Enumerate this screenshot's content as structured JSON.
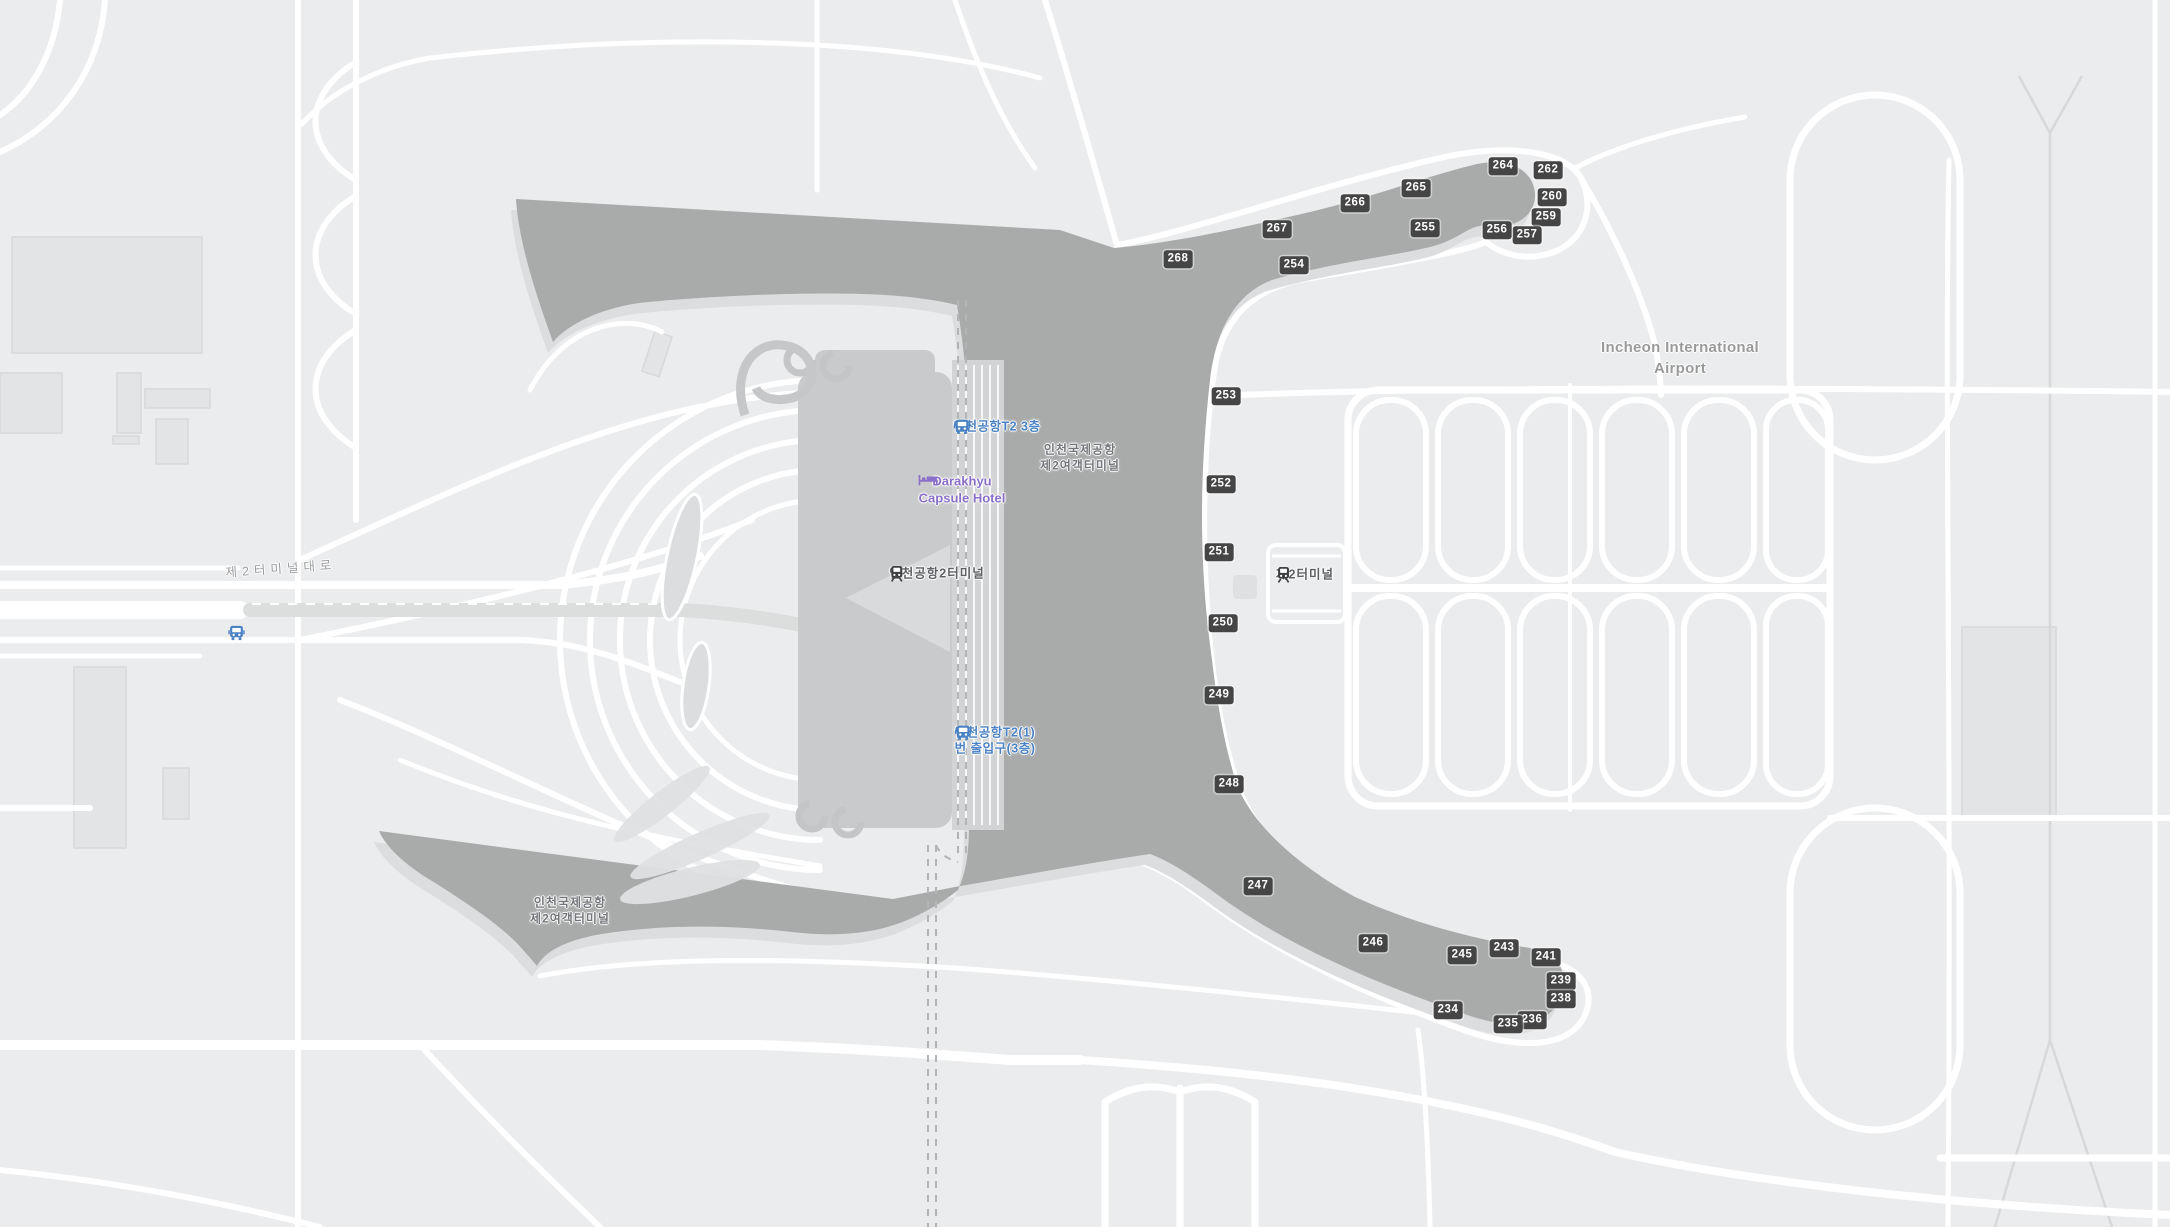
{
  "map": {
    "title": "Incheon International Airport Terminal 2 map",
    "colors": {
      "background": "#ebeced",
      "road": "#ffffff",
      "apron": "#a9abab",
      "apron_shadow": "#dcddde",
      "terminal_building": "#c9cacb",
      "terminal_wing": "#d9dadb",
      "building_light": "#e3e4e5",
      "building_stroke": "#d8d9da",
      "median_gray": "#dcdddd",
      "rail_dash": "#b3b4b5",
      "runway_line": "#d7d8d9",
      "badge_bg": "#454545",
      "badge_text": "#ffffff",
      "transit_blue": "#4a82c4",
      "lodging_purple": "#8a6fc8",
      "label_gray": "#9a9a9b"
    }
  },
  "gates": {
    "items": [
      {
        "number": "268",
        "x": 1178,
        "y": 259
      },
      {
        "number": "267",
        "x": 1277,
        "y": 229
      },
      {
        "number": "266",
        "x": 1355,
        "y": 203
      },
      {
        "number": "265",
        "x": 1416,
        "y": 188
      },
      {
        "number": "264",
        "x": 1503,
        "y": 166
      },
      {
        "number": "262",
        "x": 1548,
        "y": 170
      },
      {
        "number": "260",
        "x": 1552,
        "y": 197
      },
      {
        "number": "259",
        "x": 1546,
        "y": 217
      },
      {
        "number": "257",
        "x": 1527,
        "y": 235
      },
      {
        "number": "256",
        "x": 1497,
        "y": 230
      },
      {
        "number": "255",
        "x": 1425,
        "y": 228
      },
      {
        "number": "254",
        "x": 1294,
        "y": 265
      },
      {
        "number": "253",
        "x": 1226,
        "y": 396
      },
      {
        "number": "252",
        "x": 1221,
        "y": 484
      },
      {
        "number": "251",
        "x": 1219,
        "y": 552
      },
      {
        "number": "250",
        "x": 1223,
        "y": 623
      },
      {
        "number": "249",
        "x": 1219,
        "y": 695
      },
      {
        "number": "248",
        "x": 1229,
        "y": 784
      },
      {
        "number": "247",
        "x": 1258,
        "y": 886
      },
      {
        "number": "246",
        "x": 1373,
        "y": 943
      },
      {
        "number": "245",
        "x": 1462,
        "y": 955
      },
      {
        "number": "243",
        "x": 1504,
        "y": 948
      },
      {
        "number": "241",
        "x": 1546,
        "y": 957
      },
      {
        "number": "239",
        "x": 1561,
        "y": 981
      },
      {
        "number": "238",
        "x": 1561,
        "y": 999
      },
      {
        "number": "236",
        "x": 1532,
        "y": 1020
      },
      {
        "number": "235",
        "x": 1508,
        "y": 1024
      },
      {
        "number": "234",
        "x": 1448,
        "y": 1010
      }
    ]
  },
  "labels": {
    "items": [
      {
        "name": "incheon-airport-label",
        "type": "airport",
        "x": 1680,
        "y": 358,
        "lines": [
          "Incheon International",
          "Airport"
        ],
        "icon": null,
        "rotate": 0,
        "interactable": true
      },
      {
        "name": "terminal2-area-label-north",
        "type": "area",
        "x": 1080,
        "y": 458,
        "lines": [
          "인천국제공항",
          "제2여객터미널"
        ],
        "icon": null,
        "rotate": 0,
        "interactable": false
      },
      {
        "name": "terminal2-area-label-southwest",
        "type": "area",
        "x": 570,
        "y": 911,
        "lines": [
          "인천국제공항",
          "제2여객터미널"
        ],
        "icon": null,
        "rotate": 0,
        "interactable": false
      },
      {
        "name": "terminal2-station-label",
        "type": "station",
        "x": 937,
        "y": 575,
        "lines": [
          "인천공항2터미널"
        ],
        "icon": "train-dark",
        "rotate": 0,
        "interactable": true
      },
      {
        "name": "terminal2-parking-station-label",
        "type": "station",
        "x": 1305,
        "y": 576,
        "lines": [
          "제2터미널"
        ],
        "icon": "train-dark",
        "rotate": 0,
        "interactable": true
      },
      {
        "name": "t2-3f-bus-stop-label",
        "type": "transit",
        "x": 997,
        "y": 428,
        "lines": [
          "인천공항T2 3층"
        ],
        "icon": "bus-blue",
        "rotate": 0,
        "interactable": true
      },
      {
        "name": "t2-gate1-3f-bus-stop-label",
        "type": "transit",
        "x": 995,
        "y": 742,
        "lines": [
          "인천공항T2(1)",
          "번 출입구(3층)"
        ],
        "icon": "bus-blue",
        "rotate": 0,
        "interactable": true
      },
      {
        "name": "darakhyu-capsule-hotel-label",
        "type": "lodging",
        "x": 962,
        "y": 492,
        "lines": [
          "Darakhyu",
          "Capsule Hotel"
        ],
        "icon": "bed-purple",
        "rotate": 0,
        "interactable": true
      },
      {
        "name": "terminal2-boulevard-road-label",
        "type": "road",
        "x": 281,
        "y": 569,
        "lines": [
          "제2터미널대로"
        ],
        "icon": null,
        "rotate": -4,
        "interactable": false
      },
      {
        "name": "roadside-bus-stop-icon",
        "type": "transit",
        "x": 228,
        "y": 626,
        "lines": [],
        "icon": "bus-blue",
        "rotate": 0,
        "interactable": true
      }
    ]
  }
}
